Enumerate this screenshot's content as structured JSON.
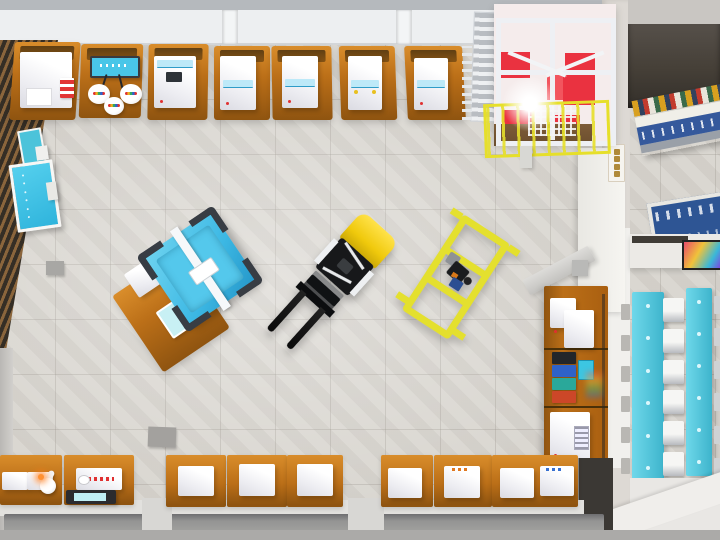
{
  "meta": {
    "scene": "Top-down 3D render of a training workshop with forklift, yellow trolley, machine benches, mezzanine cage and side corridor classroom",
    "view": "overhead"
  },
  "colors": {
    "floor": "#d7d4ce",
    "bench_hi": "#d98d2b",
    "bench_orange": "#bb6f18",
    "bench_dark": "#8f5410",
    "kiosk_strip": "#bde9f8",
    "screen_cyan": "#49c6e8",
    "red_panel": "#ea3240",
    "mezz_floor": "#6b4e2e",
    "rail_yellow": "#e6df2a",
    "forklift_yellow": "#f0c90c",
    "cart_yellow": "#e4e02e",
    "desk_cyan": "#4cc3da",
    "counter_blue": "#35599c",
    "dark_room": "#453f37",
    "wood_light": "#8a653c",
    "wood_dark": "#352e25",
    "ceiling": "#b5b9bd",
    "soffit": "#edeff1",
    "wall": "#ddd9d4",
    "wall_bright": "#f1f0ed",
    "channel": "#8c8c8d",
    "base_white": "#e2e1de",
    "case_black": "#23262a",
    "case_blue": "#2f62c8",
    "case_teal": "#2aa89a",
    "case_red": "#cc4728",
    "machine_cyan": "#3cb8e4"
  },
  "inventory": {
    "top_wall_stations": {
      "count": 7,
      "machines": [
        "white dispenser with red cartridges",
        "cyan wall screen wired to three round pots",
        "white kiosk machine",
        "white kiosk machine",
        "white kiosk machine",
        "white kiosk machine",
        "white kiosk machine"
      ]
    },
    "mezzanine": {
      "label": "steel mezzanine cage",
      "red_panels": 6,
      "features": [
        "stairs",
        "yellow safety railing",
        "work light glare",
        "walkway mesh"
      ]
    },
    "vehicles": [
      {
        "label": "forklift",
        "colors": [
          "yellow",
          "black",
          "white"
        ]
      },
      {
        "label": "yellow tube-frame trolley with small robot unit"
      }
    ],
    "center_station": {
      "label": "rotated workbench with cyan machine",
      "items": [
        "white box",
        "cyan control pad",
        "gantry bar"
      ]
    },
    "wall_shelf": {
      "sections": [
        "two white appliances",
        "stacked colored cases with cyan device",
        "white filter unit with vent"
      ]
    },
    "bottom_wall_stations": {
      "count": 8,
      "machines": [
        "twin white consoles with robot arm",
        "tester with red indicator dots and cyan tray",
        "white box machine",
        "white box machine",
        "white box machine",
        "white box machine",
        "white box machine",
        "two white box machines"
      ]
    },
    "left_wall": {
      "label": "wood slat feature wall",
      "cyan_boards": 2,
      "floor_mats": 2
    },
    "corridor": {
      "wall_sign": {
        "label": "vertical wall sign",
        "glyphs": 4,
        "note": "characters not legible"
      },
      "dark_room": 1,
      "display_counters": 2,
      "poster_screen": 1,
      "classroom": {
        "desks": 2,
        "chair_rows": 6,
        "desk_dots": 6
      }
    }
  }
}
